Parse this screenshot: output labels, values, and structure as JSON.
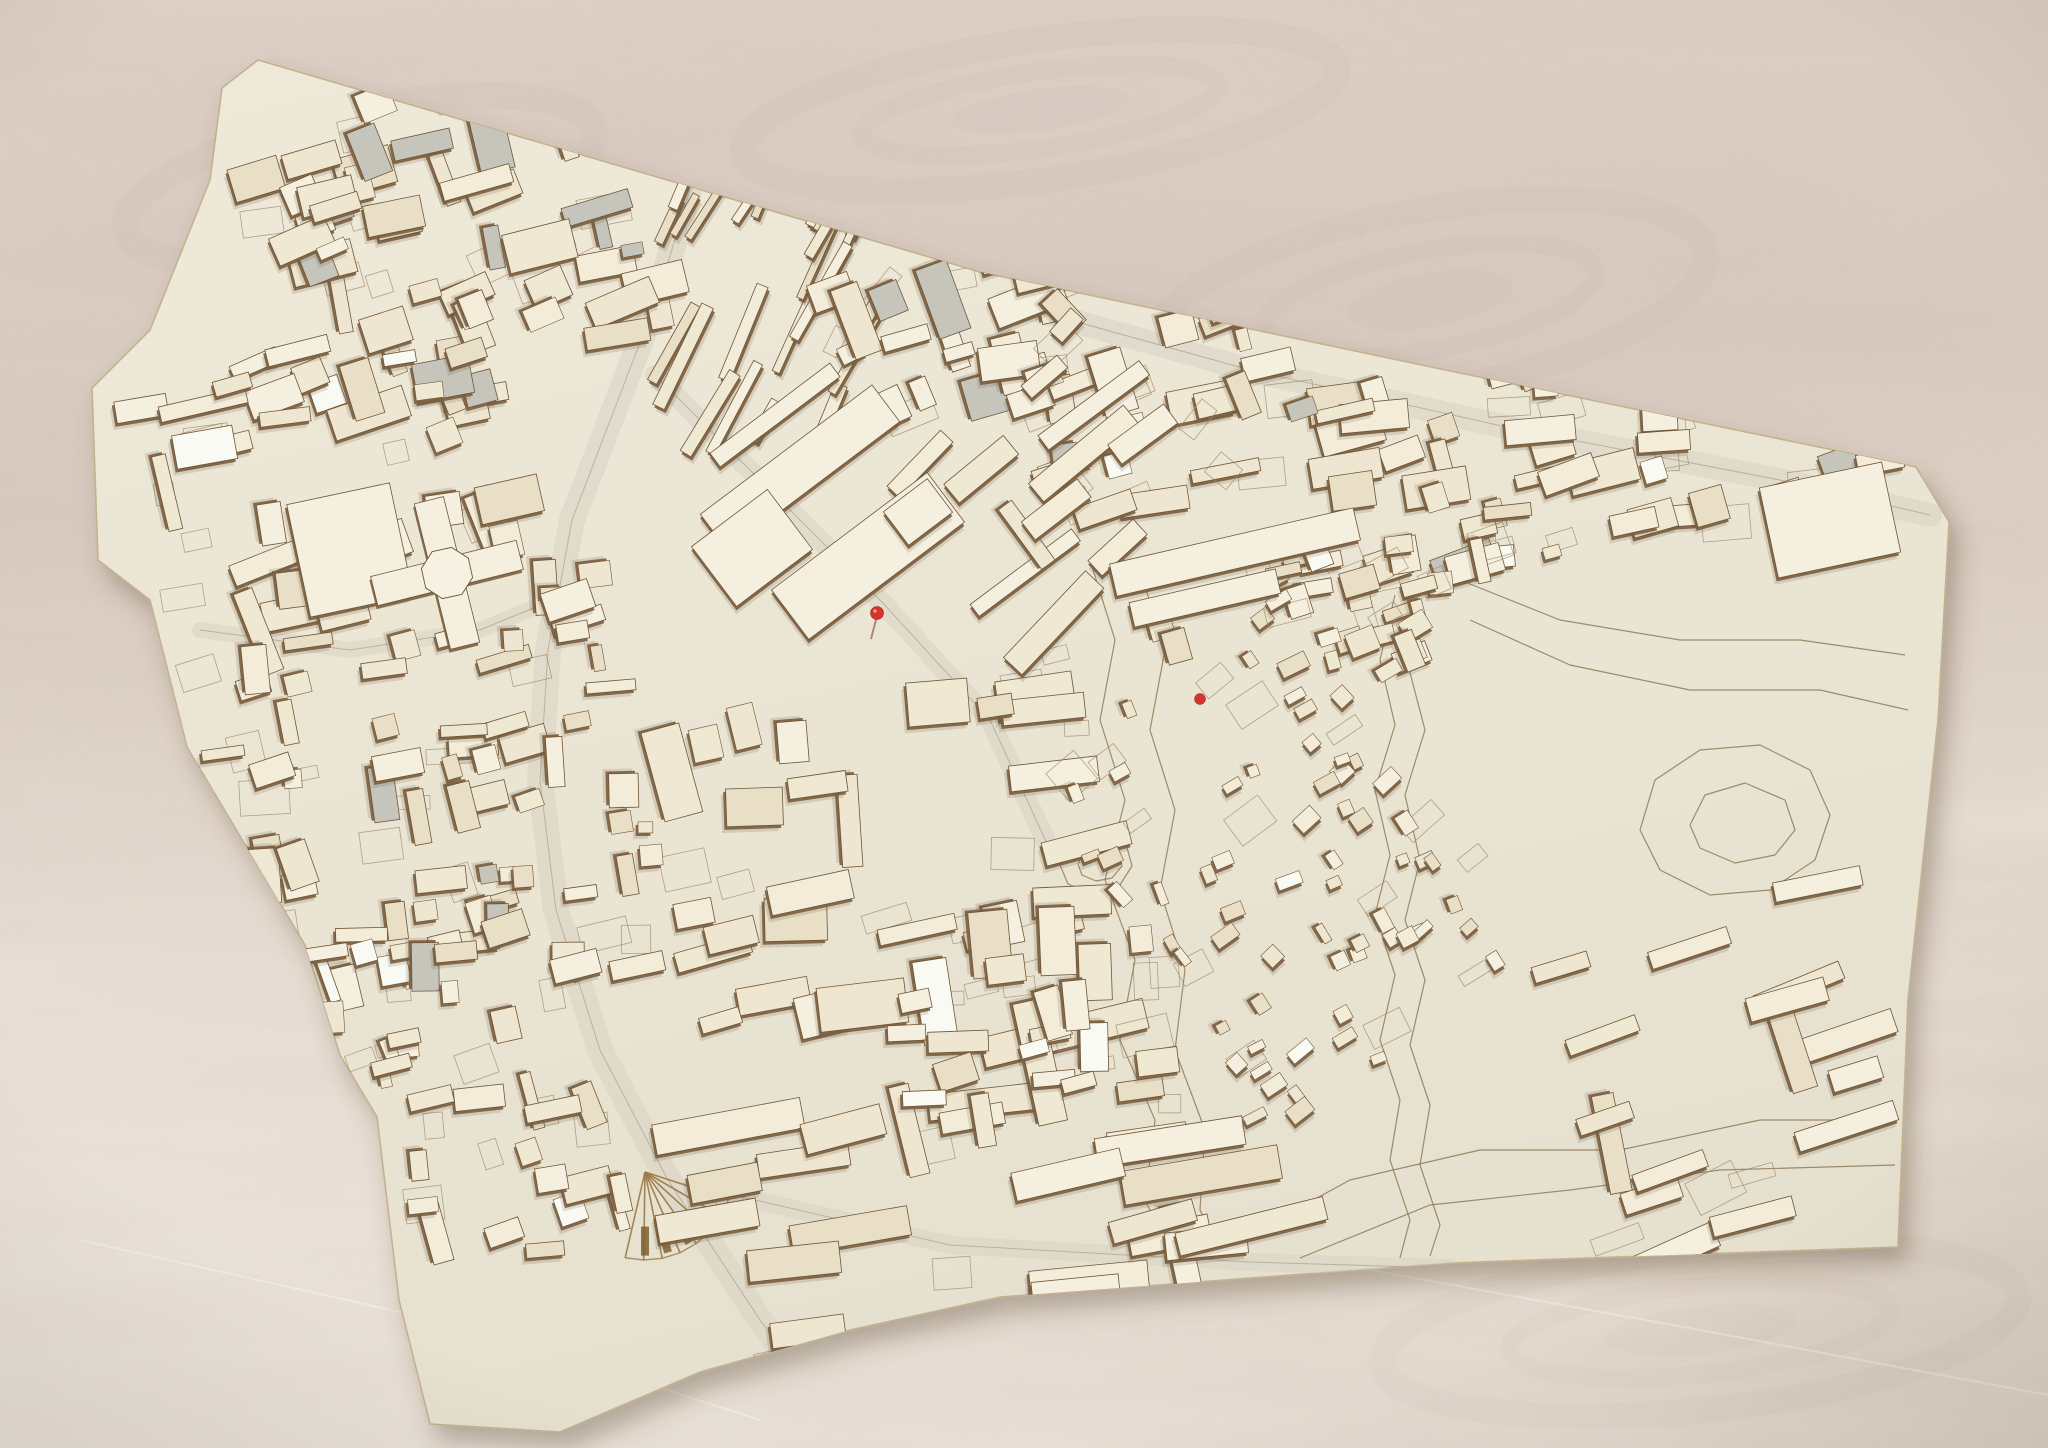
{
  "scene": {
    "description": "Photograph of a laser-cut wooden architectural scale model of a city district lying flat on a plywood table. Cream-colored building blocks with burnt brown laser-cut edges, engraved plot and contour lines, an open park with topographic contour loops on the right, a braided stream channel, a fan-shaped etched rail feature near the bottom, and two small red pin markers.",
    "object": "laser-cut architectural city model",
    "surface": "plywood table with wavy grain",
    "markers": "two red pins"
  },
  "colors": {
    "plywood_base_1": "#e2d7cc",
    "plywood_base_2": "#d8cabf",
    "plywood_base_3": "#e6dcd1",
    "plywood_streak": "#b8a498",
    "model_base_1": "#efe9d9",
    "model_base_2": "#e6e0cf",
    "model_edge": "#c3b28f",
    "street": "#d8d3c5",
    "building_side": "#7c5f40",
    "building_stroke": "#6f5636",
    "building_tops": [
      "#f2ecd9",
      "#eee6d0",
      "#f5efdf",
      "#e9dfc6",
      "#efe8d2"
    ],
    "grey_piece": "#c6c5bc",
    "glossy_piece": "#fafaf4",
    "etch_line": "#9c8a6a",
    "contour_line": "#8a7450",
    "ground_shadow": "#5a4a38",
    "red_marker": "#d6352b",
    "fan_etch": "#9a7a45"
  },
  "model": {
    "outline": [
      [
        258,
        60
      ],
      [
        640,
        172
      ],
      [
        980,
        272
      ],
      [
        1455,
        372
      ],
      [
        1916,
        467
      ],
      [
        1949,
        522
      ],
      [
        1938,
        720
      ],
      [
        1908,
        1000
      ],
      [
        1898,
        1247
      ],
      [
        1450,
        1263
      ],
      [
        1000,
        1297
      ],
      [
        850,
        1330
      ],
      [
        700,
        1372
      ],
      [
        560,
        1432
      ],
      [
        430,
        1424
      ],
      [
        399,
        1300
      ],
      [
        377,
        1117
      ],
      [
        340,
        1055
      ],
      [
        305,
        945
      ],
      [
        187,
        747
      ],
      [
        150,
        600
      ],
      [
        98,
        560
      ],
      [
        92,
        388
      ],
      [
        150,
        330
      ],
      [
        210,
        180
      ],
      [
        222,
        88
      ]
    ]
  },
  "districts": [
    {
      "name": "nw-grid",
      "cx": 430,
      "cy": 245,
      "w": 410,
      "h": 330,
      "rot": -17,
      "n": 56,
      "bw": [
        20,
        72
      ],
      "bh": [
        12,
        40
      ],
      "jitter": 8,
      "cross": 0.3,
      "grey": 0.12,
      "seed": 1,
      "plots": 12
    },
    {
      "name": "north-thin-bars",
      "cx": 762,
      "cy": 282,
      "w": 300,
      "h": 250,
      "rot": -62,
      "n": 26,
      "bw": [
        40,
        115
      ],
      "bh": [
        7,
        14
      ],
      "jitter": 6,
      "cross": 0.08,
      "grey": 0,
      "seed": 2,
      "plots": 4
    },
    {
      "name": "north-center-blocks",
      "cx": 985,
      "cy": 330,
      "w": 290,
      "h": 190,
      "rot": -20,
      "n": 18,
      "bw": [
        25,
        80
      ],
      "bh": [
        14,
        42
      ],
      "jitter": 8,
      "cross": 0.3,
      "grey": 0.08,
      "seed": 3,
      "plots": 6
    },
    {
      "name": "ne-band-west",
      "cx": 1190,
      "cy": 400,
      "w": 330,
      "h": 185,
      "rot": -15,
      "n": 26,
      "bw": [
        20,
        70
      ],
      "bh": [
        12,
        38
      ],
      "jitter": 8,
      "cross": 0.35,
      "grey": 0.05,
      "seed": 4,
      "plots": 8
    },
    {
      "name": "ne-band-east",
      "cx": 1595,
      "cy": 448,
      "w": 570,
      "h": 205,
      "rot": -12,
      "n": 46,
      "bw": [
        18,
        75
      ],
      "bh": [
        12,
        36
      ],
      "jitter": 9,
      "cross": 0.35,
      "grey": 0.06,
      "seed": 5,
      "plots": 12
    },
    {
      "name": "west-campus",
      "cx": 322,
      "cy": 485,
      "w": 360,
      "h": 270,
      "rot": -15,
      "n": 24,
      "bw": [
        28,
        90
      ],
      "bh": [
        14,
        38
      ],
      "jitter": 8,
      "cross": 0.4,
      "grey": 0,
      "seed": 6,
      "plots": 8
    },
    {
      "name": "west-oldtown",
      "cx": 430,
      "cy": 800,
      "w": 430,
      "h": 410,
      "rot": -10,
      "n": 82,
      "bw": [
        14,
        56
      ],
      "bh": [
        10,
        34
      ],
      "jitter": 10,
      "cross": 0.4,
      "grey": 0.04,
      "seed": 7,
      "plots": 16
    },
    {
      "name": "sw-tail",
      "cx": 470,
      "cy": 1145,
      "w": 270,
      "h": 270,
      "rot": -14,
      "n": 26,
      "bw": [
        16,
        60
      ],
      "bh": [
        10,
        30
      ],
      "jitter": 9,
      "cross": 0.35,
      "grey": 0,
      "seed": 8,
      "plots": 8
    },
    {
      "name": "center-campus-south",
      "cx": 880,
      "cy": 850,
      "w": 420,
      "h": 320,
      "rot": -8,
      "n": 30,
      "bw": [
        26,
        95
      ],
      "bh": [
        16,
        46
      ],
      "jitter": 9,
      "cross": 0.35,
      "grey": 0,
      "seed": 9,
      "plots": 10
    },
    {
      "name": "south-slabs",
      "cx": 960,
      "cy": 1180,
      "w": 560,
      "h": 260,
      "rot": -10,
      "n": 24,
      "bw": [
        60,
        170
      ],
      "bh": [
        20,
        34
      ],
      "jitter": 6,
      "cross": 0.12,
      "grey": 0,
      "seed": 10,
      "plots": 6
    },
    {
      "name": "center-right-bars",
      "cx": 1065,
      "cy": 470,
      "w": 250,
      "h": 240,
      "rot": -42,
      "n": 13,
      "bw": [
        30,
        130
      ],
      "bh": [
        14,
        26
      ],
      "jitter": 6,
      "cross": 0.15,
      "grey": 0,
      "seed": 11,
      "plots": 4
    },
    {
      "name": "se-houses",
      "cx": 1280,
      "cy": 870,
      "w": 310,
      "h": 450,
      "rot": -32,
      "n": 62,
      "bw": [
        10,
        26
      ],
      "bh": [
        8,
        18
      ],
      "jitter": 12,
      "cross": 0.3,
      "grey": 0,
      "seed": 12,
      "plots": 14
    },
    {
      "name": "east-rows",
      "cx": 1720,
      "cy": 1080,
      "w": 360,
      "h": 320,
      "rot": -18,
      "n": 16,
      "bw": [
        50,
        140
      ],
      "bh": [
        16,
        26
      ],
      "jitter": 7,
      "cross": 0.15,
      "grey": 0,
      "seed": 13,
      "plots": 4
    },
    {
      "name": "south-mid-cluster",
      "cx": 1030,
      "cy": 1010,
      "w": 260,
      "h": 210,
      "rot": -10,
      "n": 18,
      "bw": [
        20,
        70
      ],
      "bh": [
        14,
        36
      ],
      "jitter": 9,
      "cross": 0.3,
      "grey": 0,
      "seed": 14,
      "plots": 6
    },
    {
      "name": "ne-scatter",
      "cx": 1350,
      "cy": 565,
      "w": 400,
      "h": 120,
      "rot": -14,
      "n": 13,
      "bw": [
        15,
        50
      ],
      "bh": [
        10,
        30
      ],
      "jitter": 10,
      "cross": 0.3,
      "grey": 0,
      "seed": 15,
      "plots": 4
    },
    {
      "name": "east-mid-cluster",
      "cx": 1340,
      "cy": 608,
      "w": 180,
      "h": 160,
      "rot": -22,
      "n": 20,
      "bw": [
        12,
        40
      ],
      "bh": [
        10,
        26
      ],
      "jitter": 10,
      "cross": 0.3,
      "grey": 0,
      "seed": 16,
      "plots": 6
    }
  ],
  "landmarks": [
    {
      "name": "hospital-slab-a",
      "shape": "rect",
      "x": 800,
      "y": 468,
      "w": 215,
      "h": 46,
      "rot": -37
    },
    {
      "name": "hospital-slab-b",
      "shape": "rect",
      "x": 868,
      "y": 556,
      "w": 195,
      "h": 62,
      "rot": -37
    },
    {
      "name": "hospital-block-c",
      "shape": "rect",
      "x": 752,
      "y": 548,
      "w": 95,
      "h": 75,
      "rot": -37
    },
    {
      "name": "hospital-block-d",
      "shape": "rect",
      "x": 918,
      "y": 512,
      "w": 55,
      "h": 42,
      "rot": -37
    },
    {
      "name": "hospital-north-bar",
      "shape": "rect",
      "x": 775,
      "y": 415,
      "w": 150,
      "h": 17,
      "rot": -37
    },
    {
      "name": "northeast-long-slab",
      "shape": "rect",
      "x": 1235,
      "y": 552,
      "w": 250,
      "h": 33,
      "rot": -13
    },
    {
      "name": "northeast-slab-2",
      "shape": "rect",
      "x": 1205,
      "y": 598,
      "w": 150,
      "h": 25,
      "rot": -13
    },
    {
      "name": "ne-corner-block",
      "shape": "rect",
      "x": 1830,
      "y": 520,
      "w": 125,
      "h": 92,
      "rot": -12
    },
    {
      "name": "west-large-hall",
      "shape": "rect",
      "x": 350,
      "y": 550,
      "w": 105,
      "h": 115,
      "rot": -12
    },
    {
      "name": "cross-building",
      "shape": "cross",
      "x": 447,
      "y": 573,
      "arm": 150,
      "thick": 30,
      "rot": -14
    },
    {
      "name": "octagon-plaza",
      "shape": "hex",
      "x": 447,
      "y": 573,
      "r": 26,
      "rot": 10
    },
    {
      "name": "market-hall",
      "shape": "rect",
      "x": 906,
      "y": 338,
      "w": 48,
      "h": 16,
      "rot": -16
    },
    {
      "name": "market-hall-2",
      "shape": "rect",
      "x": 959,
      "y": 352,
      "w": 30,
      "h": 13,
      "rot": -16
    }
  ],
  "roads": [
    {
      "name": "main-north-south-road",
      "w": 26,
      "points": [
        [
          690,
          188
        ],
        [
          660,
          290
        ],
        [
          618,
          400
        ],
        [
          572,
          520
        ],
        [
          548,
          650
        ],
        [
          540,
          780
        ],
        [
          556,
          910
        ],
        [
          600,
          1050
        ],
        [
          668,
          1180
        ],
        [
          760,
          1320
        ],
        [
          820,
          1400
        ]
      ]
    },
    {
      "name": "southeast-diagonal-road",
      "w": 20,
      "points": [
        [
          655,
          375
        ],
        [
          760,
          480
        ],
        [
          880,
          600
        ],
        [
          990,
          720
        ],
        [
          1050,
          850
        ]
      ]
    },
    {
      "name": "northeast-band-road",
      "w": 24,
      "points": [
        [
          1005,
          302
        ],
        [
          1250,
          370
        ],
        [
          1520,
          430
        ],
        [
          1780,
          480
        ],
        [
          1930,
          515
        ]
      ]
    },
    {
      "name": "west-cross-road",
      "w": 16,
      "points": [
        [
          200,
          630
        ],
        [
          350,
          650
        ],
        [
          480,
          630
        ],
        [
          565,
          595
        ]
      ]
    },
    {
      "name": "south-road",
      "w": 18,
      "points": [
        [
          690,
          1185
        ],
        [
          950,
          1245
        ],
        [
          1250,
          1262
        ],
        [
          1450,
          1268
        ]
      ]
    }
  ],
  "contours": [
    {
      "name": "park-edge-1",
      "points": [
        [
          1090,
          560
        ],
        [
          1115,
          640
        ],
        [
          1100,
          720
        ],
        [
          1125,
          800
        ],
        [
          1105,
          880
        ],
        [
          1135,
          960
        ],
        [
          1120,
          1040
        ],
        [
          1155,
          1120
        ],
        [
          1145,
          1200
        ],
        [
          1175,
          1262
        ]
      ]
    },
    {
      "name": "park-edge-2",
      "points": [
        [
          1140,
          570
        ],
        [
          1165,
          650
        ],
        [
          1150,
          730
        ],
        [
          1175,
          810
        ],
        [
          1160,
          890
        ],
        [
          1185,
          970
        ],
        [
          1175,
          1050
        ],
        [
          1205,
          1130
        ],
        [
          1200,
          1210
        ],
        [
          1225,
          1258
        ]
      ]
    },
    {
      "name": "stream-west-bank",
      "points": [
        [
          1395,
          595
        ],
        [
          1380,
          660
        ],
        [
          1395,
          725
        ],
        [
          1375,
          790
        ],
        [
          1390,
          855
        ],
        [
          1375,
          915
        ],
        [
          1395,
          975
        ],
        [
          1380,
          1040
        ],
        [
          1400,
          1100
        ],
        [
          1390,
          1160
        ],
        [
          1410,
          1220
        ],
        [
          1400,
          1258
        ]
      ]
    },
    {
      "name": "stream-east-bank",
      "points": [
        [
          1420,
          600
        ],
        [
          1408,
          665
        ],
        [
          1425,
          730
        ],
        [
          1405,
          795
        ],
        [
          1420,
          860
        ],
        [
          1405,
          920
        ],
        [
          1425,
          980
        ],
        [
          1410,
          1045
        ],
        [
          1430,
          1105
        ],
        [
          1420,
          1165
        ],
        [
          1440,
          1225
        ],
        [
          1430,
          1256
        ]
      ]
    },
    {
      "name": "hill-loop-outer",
      "points": [
        [
          1640,
          830
        ],
        [
          1655,
          780
        ],
        [
          1700,
          750
        ],
        [
          1760,
          745
        ],
        [
          1810,
          770
        ],
        [
          1830,
          815
        ],
        [
          1815,
          860
        ],
        [
          1770,
          890
        ],
        [
          1710,
          895
        ],
        [
          1660,
          870
        ],
        [
          1640,
          830
        ]
      ]
    },
    {
      "name": "hill-loop-inner",
      "points": [
        [
          1690,
          825
        ],
        [
          1705,
          795
        ],
        [
          1745,
          783
        ],
        [
          1785,
          800
        ],
        [
          1795,
          830
        ],
        [
          1775,
          855
        ],
        [
          1735,
          863
        ],
        [
          1700,
          848
        ],
        [
          1690,
          825
        ]
      ]
    },
    {
      "name": "upper-park-contour-1",
      "points": [
        [
          1460,
          580
        ],
        [
          1560,
          620
        ],
        [
          1680,
          640
        ],
        [
          1800,
          640
        ],
        [
          1905,
          655
        ]
      ]
    },
    {
      "name": "upper-park-contour-2",
      "points": [
        [
          1470,
          620
        ],
        [
          1570,
          665
        ],
        [
          1690,
          690
        ],
        [
          1820,
          690
        ],
        [
          1908,
          710
        ]
      ]
    },
    {
      "name": "lower-park-contour-1",
      "points": [
        [
          1240,
          1240
        ],
        [
          1350,
          1180
        ],
        [
          1480,
          1150
        ],
        [
          1620,
          1150
        ],
        [
          1760,
          1120
        ],
        [
          1890,
          1120
        ]
      ]
    },
    {
      "name": "lower-park-contour-2",
      "points": [
        [
          1300,
          1258
        ],
        [
          1430,
          1205
        ],
        [
          1570,
          1190
        ],
        [
          1720,
          1170
        ],
        [
          1895,
          1165
        ]
      ]
    },
    {
      "name": "knoll-ring-outer",
      "points": [
        [
          1060,
          865
        ],
        [
          1070,
          838
        ],
        [
          1098,
          828
        ],
        [
          1125,
          840
        ],
        [
          1132,
          866
        ],
        [
          1118,
          888
        ],
        [
          1092,
          894
        ],
        [
          1068,
          884
        ],
        [
          1060,
          865
        ]
      ]
    },
    {
      "name": "knoll-ring-inner",
      "points": [
        [
          1078,
          864
        ],
        [
          1086,
          848
        ],
        [
          1102,
          844
        ],
        [
          1118,
          852
        ],
        [
          1122,
          866
        ],
        [
          1112,
          878
        ],
        [
          1096,
          881
        ],
        [
          1082,
          875
        ],
        [
          1078,
          864
        ]
      ]
    }
  ],
  "fan_feature": {
    "x": 645,
    "y": 1172,
    "radius": 88,
    "start": 18,
    "spread": 85,
    "lines": 8
  },
  "red_markers": [
    {
      "name": "red-pin",
      "x": 877,
      "y": 613,
      "style": "pin"
    },
    {
      "name": "red-dot",
      "x": 1200,
      "y": 699,
      "style": "dot"
    }
  ],
  "wood_knots": [
    {
      "cx": 1040,
      "cy": 110,
      "rx": 300,
      "ry": 70,
      "rot": -8
    },
    {
      "cx": 1430,
      "cy": 300,
      "rx": 280,
      "ry": 90,
      "rot": -10
    },
    {
      "cx": 360,
      "cy": 180,
      "rx": 240,
      "ry": 70,
      "rot": -12
    },
    {
      "cx": 1700,
      "cy": 1330,
      "rx": 320,
      "ry": 80,
      "rot": -6
    }
  ],
  "scratches": [
    {
      "points": [
        [
          1250,
          1248
        ],
        [
          1700,
          1330
        ],
        [
          2048,
          1395
        ]
      ]
    },
    {
      "points": [
        [
          80,
          1240
        ],
        [
          480,
          1330
        ],
        [
          760,
          1420
        ]
      ]
    }
  ]
}
